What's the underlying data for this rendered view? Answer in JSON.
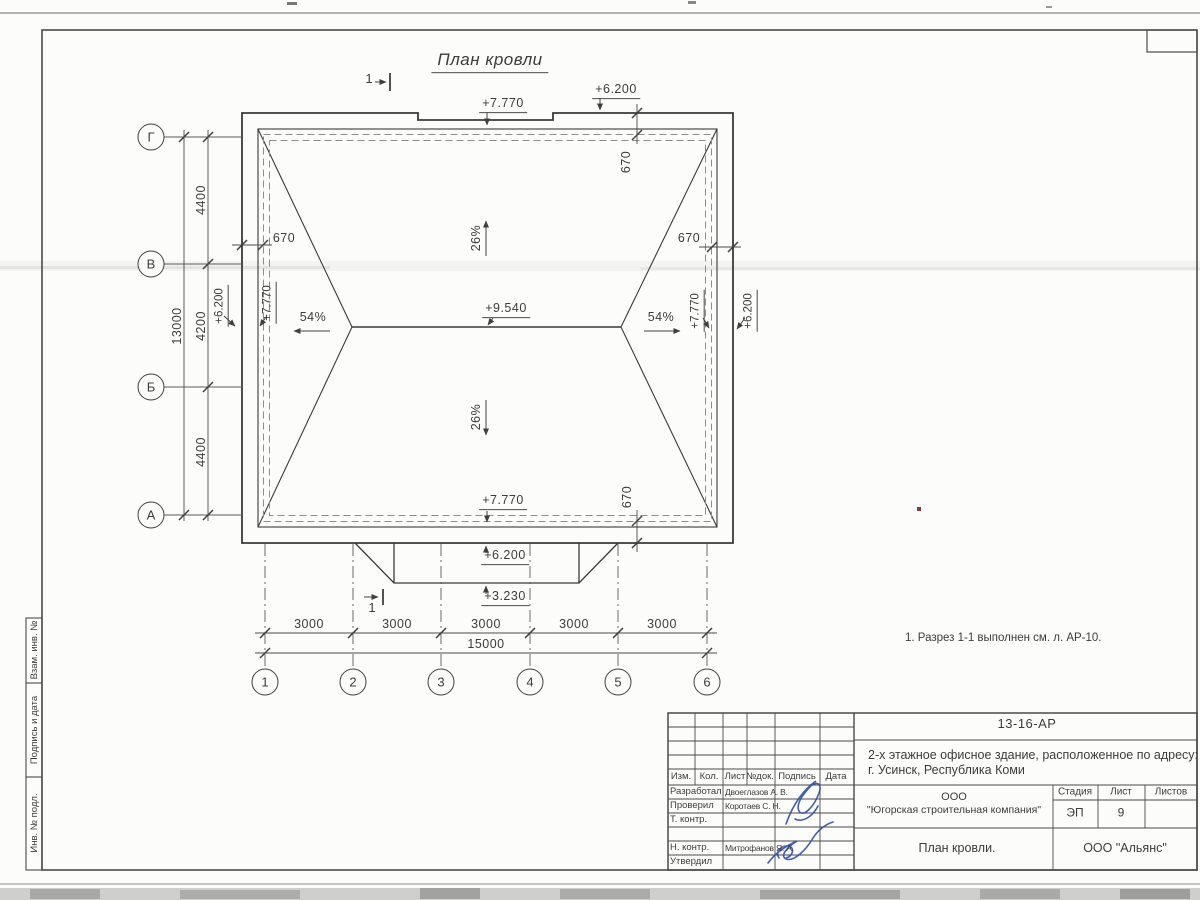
{
  "drawing": {
    "title": "План кровли",
    "section_mark": "1",
    "note": "1. Разрез 1-1 выполнен см. л. АР-10.",
    "slopes": {
      "cross": "26%",
      "long": "54%"
    },
    "elevations": {
      "ridge": "+9.540",
      "parapet_high": "+7.770",
      "parapet_low": "+6.200",
      "canopy": "+3.230"
    },
    "overhang": "670",
    "axes": {
      "letters": [
        "Г",
        "В",
        "Б",
        "А"
      ],
      "numbers": [
        "1",
        "2",
        "3",
        "4",
        "5",
        "6"
      ],
      "left_dims": [
        "4400",
        "4200",
        "4400"
      ],
      "left_total": "13000",
      "bottom_dims": [
        "3000",
        "3000",
        "3000",
        "3000",
        "3000"
      ],
      "bottom_total": "15000"
    }
  },
  "title_block": {
    "doc_number": "13-16-АР",
    "object_line1": "2-х этажное офисное здание, расположенное по адресу:",
    "object_line2": "г. Усинск, Республика Коми",
    "designer_line1": "ООО",
    "designer_line2": "\"Югорская строительная компания\"",
    "stage_label": "Стадия",
    "sheet_label": "Лист",
    "sheets_label": "Листов",
    "stage": "ЭП",
    "sheet_number": "9",
    "sheets_total": "",
    "drawing_name": "План кровли.",
    "contractor": "ООО \"Альянс\"",
    "columns": {
      "izm": "Изм.",
      "kol": "Кол.",
      "list": "Лист",
      "doc": "№док.",
      "sign": "Подпись",
      "date": "Дата"
    },
    "roles": [
      {
        "role": "Разработал",
        "name": "Двоеглазов А. В."
      },
      {
        "role": "Проверил",
        "name": "Коротаев С. Н."
      },
      {
        "role": "Т. контр.",
        "name": ""
      },
      {
        "role": "Н. контр.",
        "name": "Митрофанов Я. А."
      },
      {
        "role": "Утвердил",
        "name": ""
      }
    ]
  },
  "side_stamps": {
    "top": "Взам. инв. №",
    "middle": "Подпись и дата",
    "bottom": "Инв. № подл."
  }
}
